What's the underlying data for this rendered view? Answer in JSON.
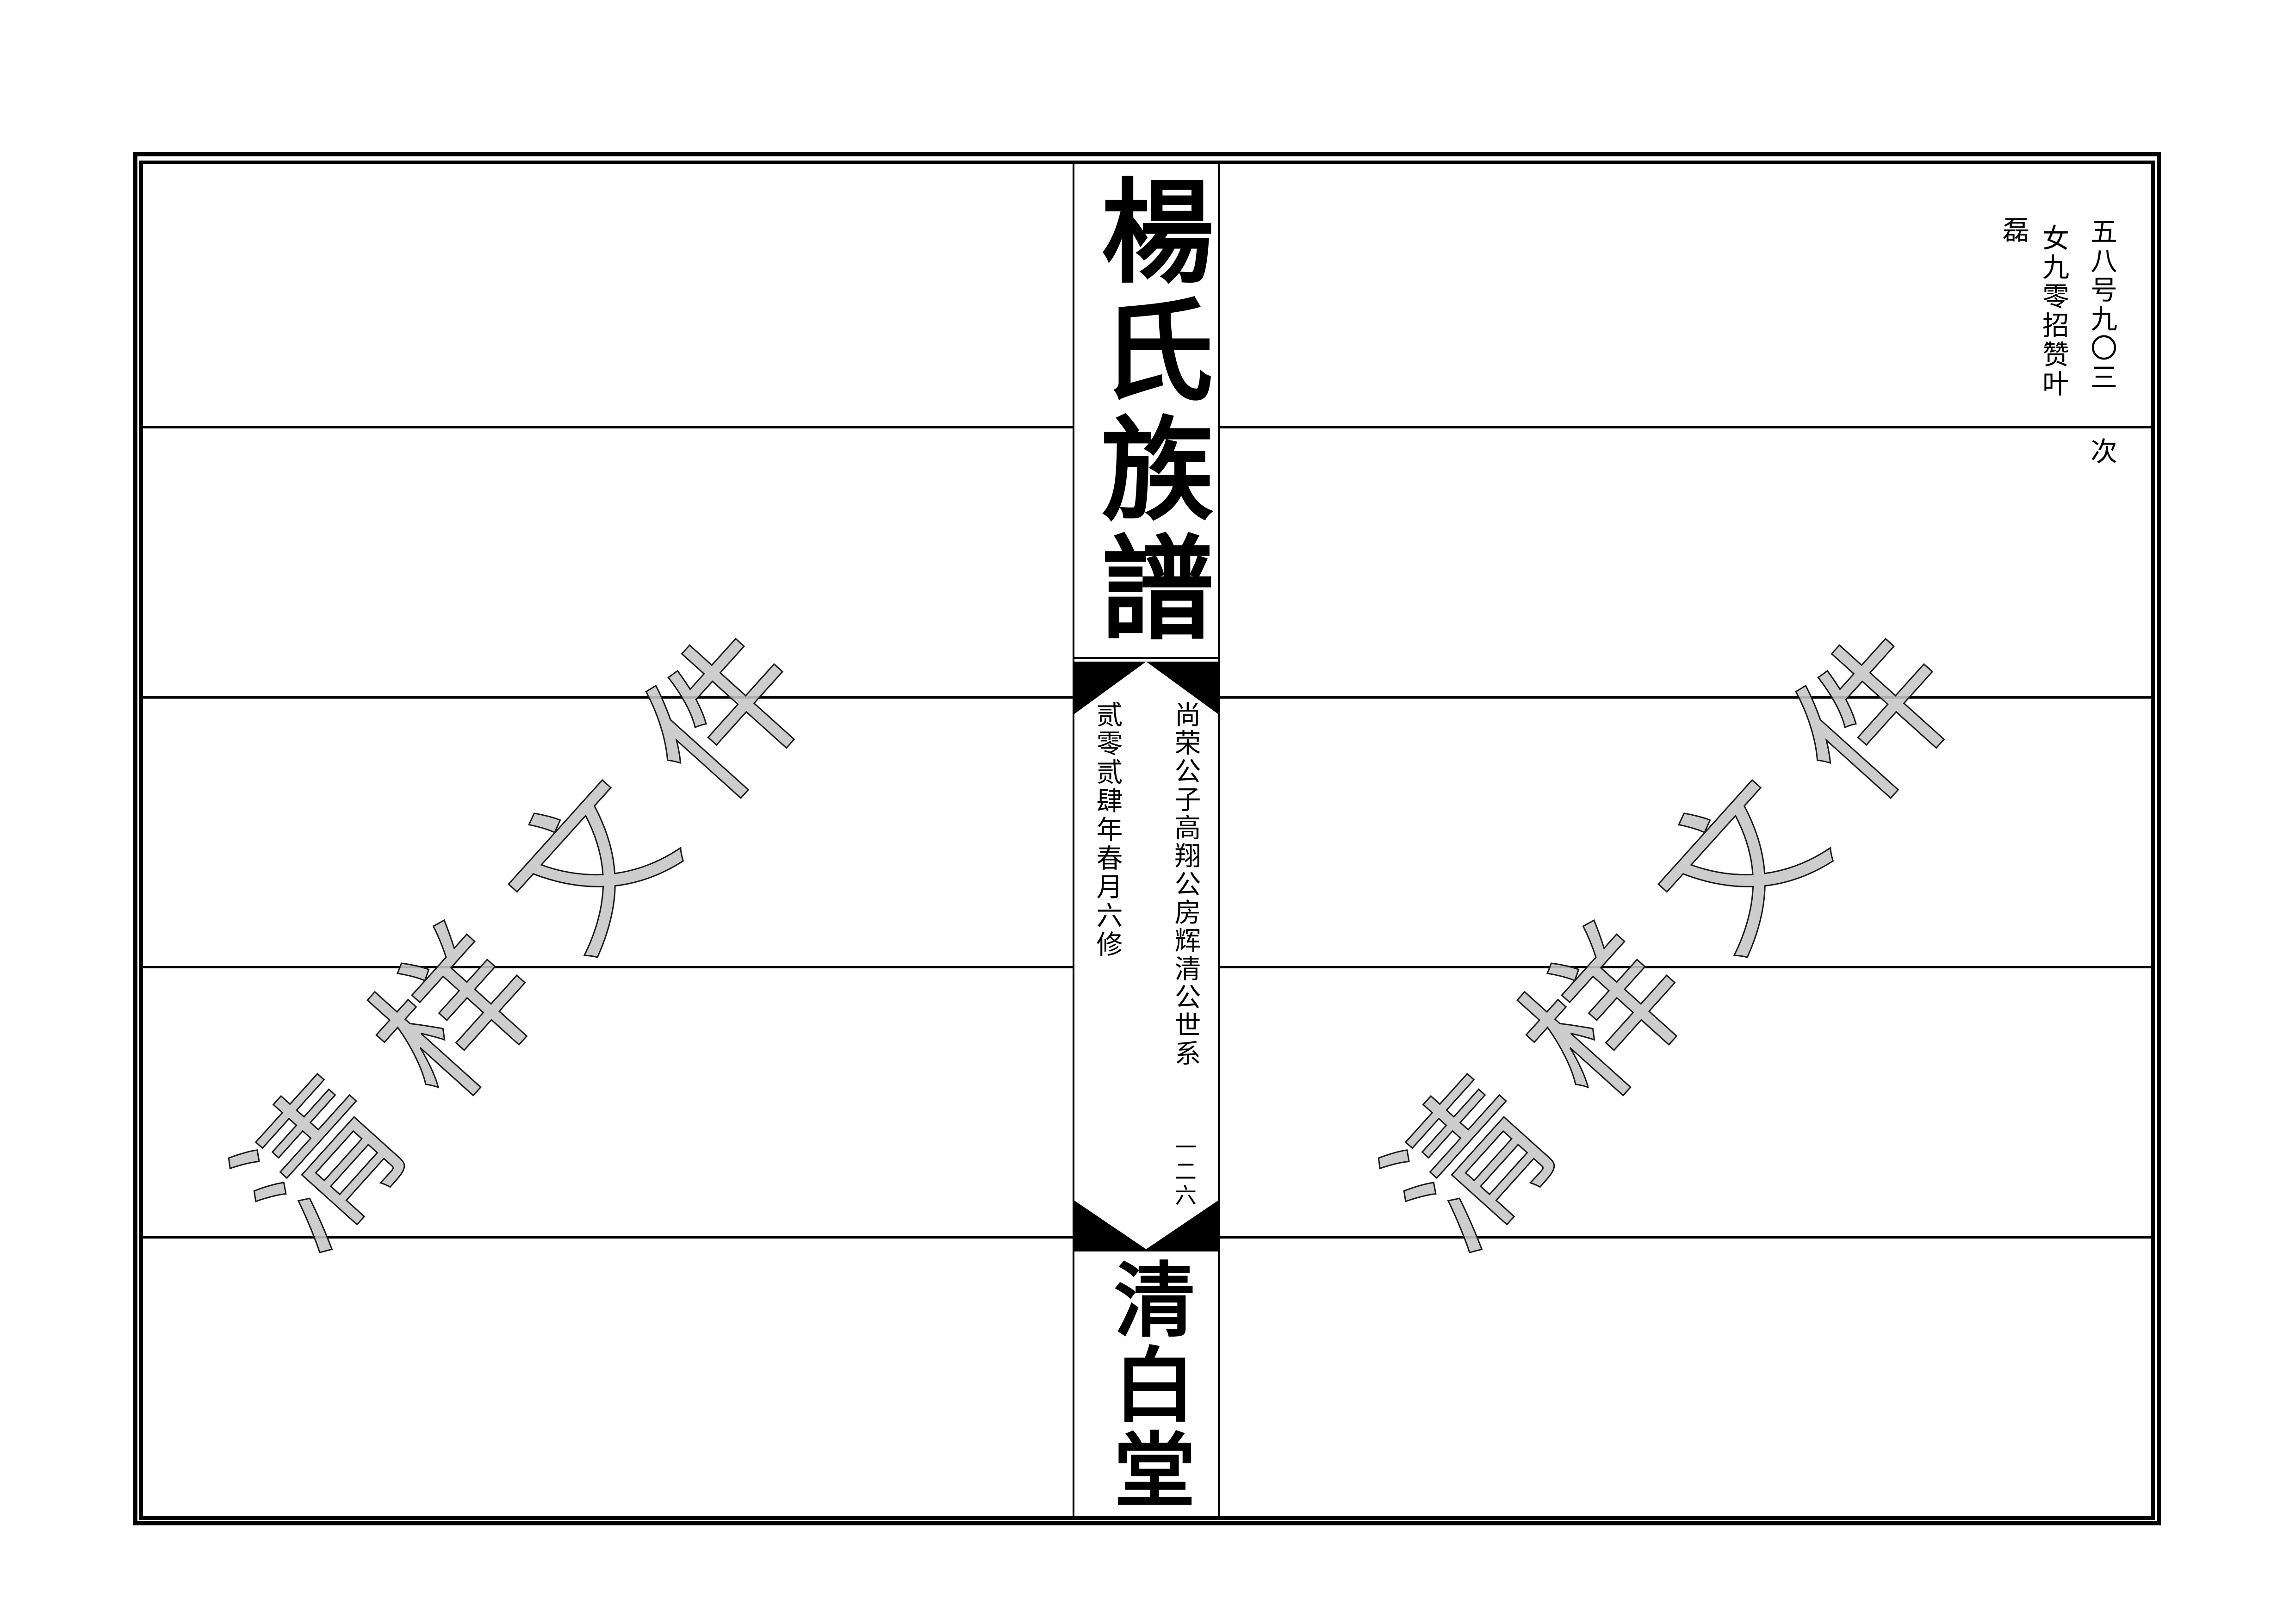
{
  "spine": {
    "title": "楊氏族譜",
    "lineage_line": "尚荣公子高翔公房辉清公世系",
    "edition_line": "贰零贰肆年春月六修",
    "page_number": "一二六",
    "hall_name": "清白堂"
  },
  "margin_notes": {
    "column_1": "五八号九〇三",
    "column_2": "女九零招赞叶",
    "column_3": "磊",
    "next_label": "次"
  },
  "watermark": {
    "text": "清样文件",
    "fill_color": "#c6c6c6",
    "outline_color": "#1a1a1a"
  },
  "colors": {
    "ink": "#000000",
    "paper": "#ffffff"
  }
}
